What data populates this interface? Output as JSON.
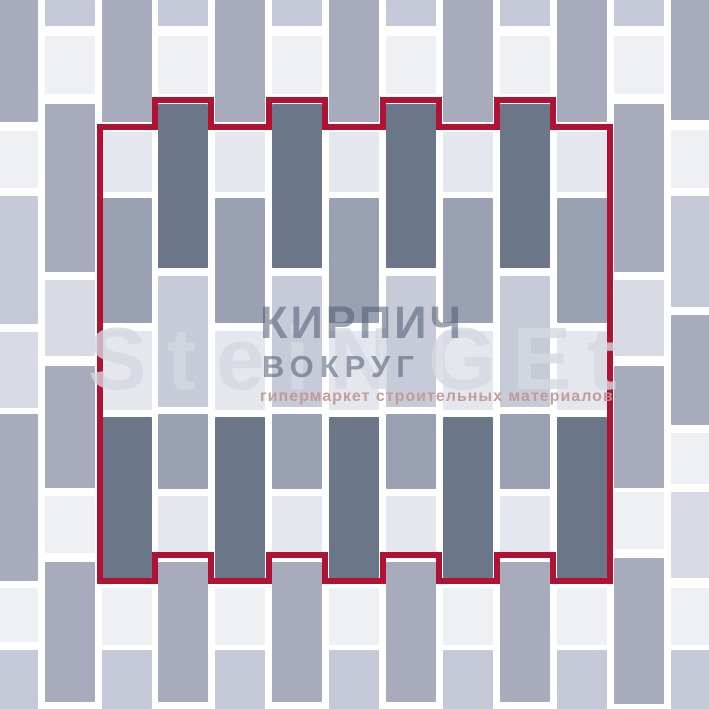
{
  "canvas": {
    "width": 709,
    "height": 709,
    "background": "#ffffff"
  },
  "palette": {
    "grayOut": "#a8abbc",
    "white": "#eef0f4",
    "lav": "#c5c8d6",
    "lavLight": "#d8dbe4",
    "dark": "#6b7689",
    "grayIn": "#99a1b2",
    "lightIn": "#e4e7ed",
    "lavIn": "#c7cbd8"
  },
  "outline": {
    "color": "#b01233",
    "stroke_width": 6,
    "path": "M 100 127 L 155 127 L 155 100 L 211 100 L 211 127 L 269 127 L 269 100 L 325 100 L 325 127 L 383 127 L 383 100 L 439 100 L 439 127 L 497 127 L 497 100 L 553 100 L 553 127 L 610 127 L 610 581 L 553 581 L 553 555 L 497 555 L 497 581 L 439 581 L 439 555 L 383 555 L 383 581 L 325 581 L 325 555 L 269 555 L 269 581 L 211 581 L 211 555 L 155 555 L 155 581 L 100 581 Z"
  },
  "watermark": {
    "brand_latin_1": "SteiN",
    "brand_latin_2": "GEt",
    "brand_cyr_1": "КИРПИЧ",
    "brand_cyr_2": "ВОКРУГ",
    "tagline": "гипермаркет строительных материалов",
    "latin_color": "rgba(213,216,225,0.80)",
    "cyr_color": "rgba(77,89,114,0.55)",
    "tagline_color": "rgba(193,153,146,0.95)"
  },
  "bricks": {
    "width": 50,
    "columns": [
      {
        "x": -12,
        "cells": [
          [
            0,
            122,
            "grayOut"
          ],
          [
            131,
            57,
            "white"
          ],
          [
            196,
            128,
            "lav"
          ],
          [
            332,
            76,
            "lavLight"
          ],
          [
            414,
            167,
            "grayOut"
          ],
          [
            588,
            54,
            "white"
          ],
          [
            650,
            59,
            "lav"
          ]
        ]
      },
      {
        "x": 45,
        "cells": [
          [
            0,
            26,
            "lav"
          ],
          [
            36,
            58,
            "white"
          ],
          [
            104,
            168,
            "grayOut"
          ],
          [
            280,
            76,
            "lavLight"
          ],
          [
            366,
            122,
            "grayOut"
          ],
          [
            496,
            57,
            "white"
          ],
          [
            562,
            140,
            "grayOut"
          ]
        ]
      },
      {
        "x": 102,
        "cells": [
          [
            0,
            122,
            "grayOut"
          ],
          [
            132,
            60,
            "lightIn"
          ],
          [
            198,
            125,
            "grayIn"
          ],
          [
            331,
            79,
            "lightIn"
          ],
          [
            417,
            161,
            "dark"
          ],
          [
            588,
            57,
            "white"
          ],
          [
            650,
            59,
            "lav"
          ]
        ]
      },
      {
        "x": 158,
        "cells": [
          [
            0,
            26,
            "lav"
          ],
          [
            36,
            58,
            "white"
          ],
          [
            104,
            164,
            "dark"
          ],
          [
            276,
            131,
            "lavIn"
          ],
          [
            414,
            75,
            "grayIn"
          ],
          [
            496,
            57,
            "lightIn"
          ],
          [
            562,
            140,
            "grayOut"
          ]
        ]
      },
      {
        "x": 215,
        "cells": [
          [
            0,
            122,
            "grayOut"
          ],
          [
            132,
            60,
            "lightIn"
          ],
          [
            198,
            125,
            "grayIn"
          ],
          [
            331,
            79,
            "lightIn"
          ],
          [
            417,
            161,
            "dark"
          ],
          [
            588,
            57,
            "white"
          ],
          [
            650,
            59,
            "lav"
          ]
        ]
      },
      {
        "x": 272,
        "cells": [
          [
            0,
            26,
            "lav"
          ],
          [
            36,
            58,
            "white"
          ],
          [
            104,
            164,
            "dark"
          ],
          [
            276,
            131,
            "lavIn"
          ],
          [
            414,
            75,
            "grayIn"
          ],
          [
            496,
            57,
            "lightIn"
          ],
          [
            562,
            140,
            "grayOut"
          ]
        ]
      },
      {
        "x": 329,
        "cells": [
          [
            0,
            122,
            "grayOut"
          ],
          [
            132,
            60,
            "lightIn"
          ],
          [
            198,
            125,
            "grayIn"
          ],
          [
            331,
            79,
            "lightIn"
          ],
          [
            417,
            161,
            "dark"
          ],
          [
            588,
            57,
            "white"
          ],
          [
            650,
            59,
            "lav"
          ]
        ]
      },
      {
        "x": 386,
        "cells": [
          [
            0,
            26,
            "lav"
          ],
          [
            36,
            58,
            "white"
          ],
          [
            104,
            164,
            "dark"
          ],
          [
            276,
            131,
            "lavIn"
          ],
          [
            414,
            75,
            "grayIn"
          ],
          [
            496,
            57,
            "lightIn"
          ],
          [
            562,
            140,
            "grayOut"
          ]
        ]
      },
      {
        "x": 443,
        "cells": [
          [
            0,
            122,
            "grayOut"
          ],
          [
            132,
            60,
            "lightIn"
          ],
          [
            198,
            125,
            "grayIn"
          ],
          [
            331,
            79,
            "lightIn"
          ],
          [
            417,
            161,
            "dark"
          ],
          [
            588,
            57,
            "white"
          ],
          [
            650,
            59,
            "lav"
          ]
        ]
      },
      {
        "x": 500,
        "cells": [
          [
            0,
            26,
            "lav"
          ],
          [
            36,
            58,
            "white"
          ],
          [
            104,
            164,
            "dark"
          ],
          [
            276,
            131,
            "lavIn"
          ],
          [
            414,
            75,
            "grayIn"
          ],
          [
            496,
            57,
            "lightIn"
          ],
          [
            562,
            140,
            "grayOut"
          ]
        ]
      },
      {
        "x": 557,
        "cells": [
          [
            0,
            122,
            "grayOut"
          ],
          [
            132,
            60,
            "lightIn"
          ],
          [
            198,
            125,
            "grayIn"
          ],
          [
            331,
            79,
            "lightIn"
          ],
          [
            417,
            161,
            "dark"
          ],
          [
            588,
            57,
            "white"
          ],
          [
            650,
            59,
            "lav"
          ]
        ]
      },
      {
        "x": 614,
        "cells": [
          [
            0,
            26,
            "lav"
          ],
          [
            36,
            58,
            "white"
          ],
          [
            104,
            168,
            "grayOut"
          ],
          [
            280,
            76,
            "lavLight"
          ],
          [
            366,
            122,
            "grayOut"
          ],
          [
            492,
            57,
            "white"
          ],
          [
            558,
            146,
            "grayOut"
          ]
        ]
      },
      {
        "x": 671,
        "cells": [
          [
            0,
            120,
            "grayOut"
          ],
          [
            130,
            58,
            "white"
          ],
          [
            196,
            111,
            "lav"
          ],
          [
            315,
            110,
            "grayOut"
          ],
          [
            433,
            51,
            "white"
          ],
          [
            492,
            86,
            "lavLight"
          ],
          [
            588,
            57,
            "white"
          ],
          [
            650,
            59,
            "lav"
          ]
        ]
      }
    ]
  }
}
